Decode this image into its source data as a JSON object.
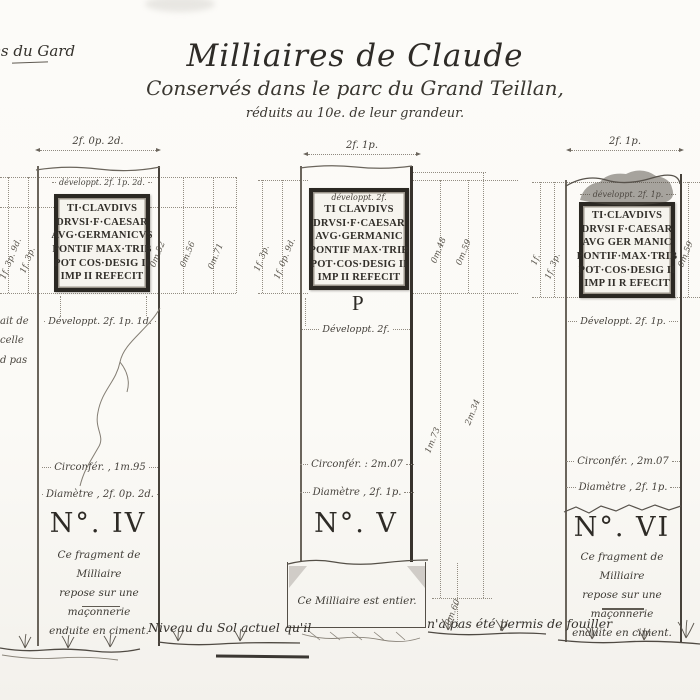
{
  "header": {
    "corner_note": "es du Gard",
    "title": "Milliaires de Claude",
    "subtitle": "Conservés dans le parc du Grand Teillan,",
    "scale_note": "réduits au 10e. de leur grandeur."
  },
  "margin_fragments": [
    "ait de",
    "celle",
    "d pas"
  ],
  "ground": {
    "left_note": "Niveau du Sol actuel qu'il",
    "right_note": "n'a pas été permis de fouiller"
  },
  "columns": [
    {
      "number": "N°. IV",
      "top_dim": "2f. 0p. 2d.",
      "developpt_plaque": "développt. 2f. 1p. 2d.",
      "plaque": [
        "TI·CLAVDIVS",
        "DRVSI·F·CAESAR",
        "AVG·GERMANICVS",
        "PONTIF MAX·TRIB",
        "POT COS·DESIG II",
        "IMP II REFECIT"
      ],
      "left_dims": [
        "1f. 3p. 9d.",
        "1f. 3p."
      ],
      "right_dims": [
        "0m.52",
        "0m.56",
        "0m.71"
      ],
      "developpt_shaft": "Développt. 2f. 1p. 1d.",
      "circonference": "Circonfér. , 1m.95",
      "diametre": "Diamètre , 2f. 0p. 2d.",
      "note": [
        "Ce fragment de Milliaire",
        "repose sur une maçonnerie",
        "enduite en ciment."
      ]
    },
    {
      "number": "N°. V",
      "top_dim": "2f. 1p.",
      "developpt_plaque": "développt. 2f.",
      "plaque": [
        "TI CLAVDIVS",
        "DRVSI·F·CAESAR",
        "AVG·GERMANIC",
        "PONTIF MAX·TRIB",
        "POT·COS·DESIG II",
        "IMP II REFECIT"
      ],
      "sub_letter": "P",
      "left_dims": [
        "1f. 3p.",
        "1f. 0p. 9d."
      ],
      "right_dims": [
        "0m.48",
        "0m.59"
      ],
      "height_dims": [
        "1m.73",
        "2m.34"
      ],
      "developpt_shaft": "Développt. 2f.",
      "circonference": "Circonfér. : 2m.07",
      "diametre": "Diamètre , 2f. 1p.",
      "base_dim": "0m.60",
      "note": [
        "Ce Milliaire est entier."
      ]
    },
    {
      "number": "N°. VI",
      "top_dim": "2f. 1p.",
      "developpt_plaque": "développt. 2f. 1p.",
      "plaque": [
        "TI·CLAVDIVS",
        "DRVSI F·CAESAR",
        "AVG GER MANIC",
        "PONTIF·MAX·TRIB",
        "POT·COS·DESIG II",
        "IMP II R EFECIT"
      ],
      "left_dims": [
        "1f.",
        "1f. 3p."
      ],
      "right_dims": [
        "0m.59"
      ],
      "developpt_shaft": "Développt. 2f. 1p.",
      "circonference": "Circonfér. , 2m.07",
      "diametre": "Diamètre , 2f. 1p.",
      "note": [
        "Ce fragment de Milliaire",
        "repose sur une maçonnerie",
        "enduite en ciment."
      ]
    }
  ]
}
